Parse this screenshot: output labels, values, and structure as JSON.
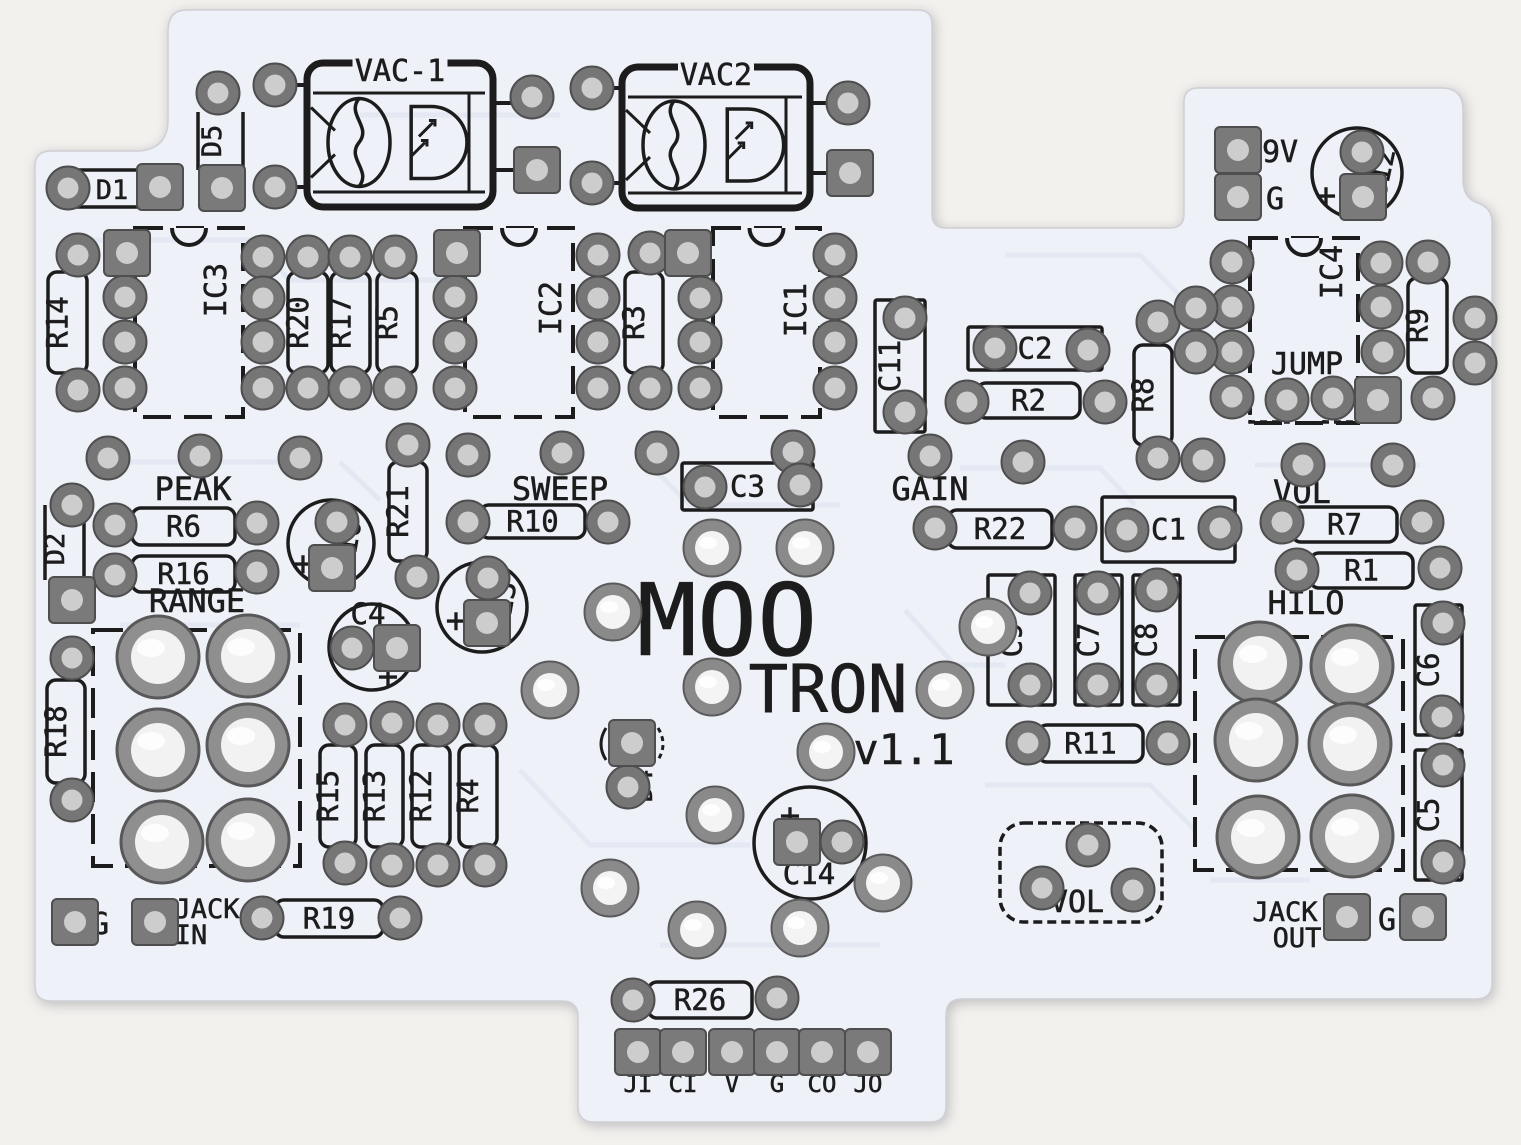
{
  "meta": {
    "subject": "MOO TRON v1.1 guitar-pedal PCB silkscreen scan"
  },
  "colors": {
    "page_bg": "#f3f1ee",
    "board": "#eef1f8",
    "silk": "#1c1c1c",
    "trace": "#e2e6f1",
    "pad_ring": "#767676",
    "pad_edge": "#4e4e4e",
    "hole_gray": "#cdcdcd",
    "hole_bright": "#f4f4f4",
    "big_ring": "#8f8f8f"
  },
  "symbols": {
    "plus": "+"
  },
  "labels": [
    {
      "t": "PEAK",
      "x": 193,
      "y": 500,
      "s": 32
    },
    {
      "t": "RANGE",
      "x": 197,
      "y": 612,
      "s": 32
    },
    {
      "t": "SWEEP",
      "x": 560,
      "y": 500,
      "s": 32
    },
    {
      "t": "GAIN",
      "x": 930,
      "y": 500,
      "s": 32
    },
    {
      "t": "VOL",
      "x": 1302,
      "y": 503,
      "s": 32
    },
    {
      "t": "HILO",
      "x": 1306,
      "y": 614,
      "s": 32
    },
    {
      "t": "JUMP",
      "x": 1307,
      "y": 374,
      "s": 30
    },
    {
      "t": "9V",
      "x": 1262,
      "y": 162,
      "s": 30,
      "anchor": "start"
    },
    {
      "t": "G",
      "x": 1266,
      "y": 209,
      "s": 30,
      "anchor": "start"
    },
    {
      "t": "G",
      "x": 100,
      "y": 934,
      "s": 30
    },
    {
      "t": "JACK",
      "x": 207,
      "y": 918,
      "s": 27
    },
    {
      "t": "IN",
      "x": 191,
      "y": 944,
      "s": 27
    },
    {
      "t": "JACK",
      "x": 1285,
      "y": 921,
      "s": 27
    },
    {
      "t": "OUT",
      "x": 1297,
      "y": 947,
      "s": 27
    },
    {
      "t": "G",
      "x": 1387,
      "y": 930,
      "s": 30
    },
    {
      "t": "MOO",
      "x": 727,
      "y": 655,
      "s": 100
    },
    {
      "t": "TRON",
      "x": 828,
      "y": 712,
      "s": 66
    },
    {
      "t": "v1.1",
      "x": 904,
      "y": 764,
      "s": 42
    },
    {
      "t": "VOL",
      "x": 1077,
      "y": 912,
      "s": 30
    },
    {
      "t": "JI",
      "x": 638,
      "y": 1092,
      "s": 24
    },
    {
      "t": "CI",
      "x": 683,
      "y": 1092,
      "s": 24
    },
    {
      "t": "V",
      "x": 732,
      "y": 1092,
      "s": 24
    },
    {
      "t": "G",
      "x": 777,
      "y": 1092,
      "s": 24
    },
    {
      "t": "CO",
      "x": 822,
      "y": 1092,
      "s": 24
    },
    {
      "t": "JO",
      "x": 868,
      "y": 1092,
      "s": 24
    }
  ],
  "resistors": [
    {
      "label": "R14",
      "x": 48,
      "y": 272,
      "w": 39,
      "h": 101,
      "vert": true
    },
    {
      "label": "R20",
      "x": 288,
      "y": 272,
      "w": 40,
      "h": 101,
      "vert": true
    },
    {
      "label": "R17",
      "x": 331,
      "y": 272,
      "w": 39,
      "h": 101,
      "vert": true
    },
    {
      "label": "R5",
      "x": 377,
      "y": 272,
      "w": 40,
      "h": 101,
      "vert": true
    },
    {
      "label": "R3",
      "x": 625,
      "y": 272,
      "w": 38,
      "h": 101,
      "vert": true
    },
    {
      "label": "R8",
      "x": 1134,
      "y": 345,
      "w": 38,
      "h": 100,
      "vert": true
    },
    {
      "label": "R9",
      "x": 1408,
      "y": 278,
      "w": 39,
      "h": 95,
      "vert": true
    },
    {
      "label": "R21",
      "x": 389,
      "y": 462,
      "w": 38,
      "h": 99,
      "vert": true
    },
    {
      "label": "R18",
      "x": 47,
      "y": 680,
      "w": 38,
      "h": 103,
      "vert": true
    },
    {
      "label": "R15",
      "x": 320,
      "y": 745,
      "w": 36,
      "h": 102,
      "vert": true
    },
    {
      "label": "R13",
      "x": 366,
      "y": 745,
      "w": 37,
      "h": 102,
      "vert": true
    },
    {
      "label": "R12",
      "x": 412,
      "y": 745,
      "w": 38,
      "h": 102,
      "vert": true
    },
    {
      "label": "R4",
      "x": 459,
      "y": 745,
      "w": 38,
      "h": 102,
      "vert": true
    },
    {
      "label": "R6",
      "x": 132,
      "y": 508,
      "w": 103,
      "h": 37,
      "vert": false
    },
    {
      "label": "R16",
      "x": 132,
      "y": 556,
      "w": 103,
      "h": 36,
      "vert": false
    },
    {
      "label": "R10",
      "x": 480,
      "y": 505,
      "w": 105,
      "h": 33,
      "vert": false
    },
    {
      "label": "R22",
      "x": 948,
      "y": 510,
      "w": 104,
      "h": 38,
      "vert": false
    },
    {
      "label": "R2",
      "x": 977,
      "y": 383,
      "w": 103,
      "h": 35,
      "vert": false
    },
    {
      "label": "R7",
      "x": 1292,
      "y": 507,
      "w": 105,
      "h": 35,
      "vert": false
    },
    {
      "label": "R1",
      "x": 1310,
      "y": 553,
      "w": 103,
      "h": 35,
      "vert": false
    },
    {
      "label": "R11",
      "x": 1038,
      "y": 725,
      "w": 105,
      "h": 37,
      "vert": false
    },
    {
      "label": "R19",
      "x": 275,
      "y": 900,
      "w": 108,
      "h": 37,
      "vert": false
    },
    {
      "label": "R26",
      "x": 648,
      "y": 982,
      "w": 104,
      "h": 36,
      "vert": false
    }
  ],
  "cap_boxes": [
    {
      "label": "C11",
      "x": 875,
      "y": 300,
      "w": 50,
      "h": 132,
      "vert": true
    },
    {
      "label": "C2",
      "x": 968,
      "y": 327,
      "w": 134,
      "h": 43,
      "vert": false
    },
    {
      "label": "C1",
      "x": 1102,
      "y": 497,
      "w": 133,
      "h": 65,
      "vert": false
    },
    {
      "label": "C3",
      "x": 682,
      "y": 463,
      "w": 131,
      "h": 47,
      "vert": false
    },
    {
      "label": "C9",
      "x": 988,
      "y": 575,
      "w": 67,
      "h": 130,
      "vert": true
    },
    {
      "label": "C7",
      "x": 1075,
      "y": 575,
      "w": 47,
      "h": 130,
      "vert": true
    },
    {
      "label": "C8",
      "x": 1133,
      "y": 575,
      "w": 47,
      "h": 130,
      "vert": true
    },
    {
      "label": "C6",
      "x": 1415,
      "y": 605,
      "w": 47,
      "h": 130,
      "vert": true
    },
    {
      "label": "C5",
      "x": 1415,
      "y": 750,
      "w": 47,
      "h": 130,
      "vert": true
    }
  ],
  "ics": [
    {
      "label": "IC3",
      "x": 135,
      "y": 228,
      "w": 108,
      "h": 189,
      "lx": 226,
      "ly": 290
    },
    {
      "label": "IC2",
      "x": 465,
      "y": 228,
      "w": 108,
      "h": 189,
      "lx": 561,
      "ly": 308
    },
    {
      "label": "IC1",
      "x": 713,
      "y": 228,
      "w": 107,
      "h": 189,
      "lx": 806,
      "ly": 310
    },
    {
      "label": "IC4",
      "x": 1250,
      "y": 238,
      "w": 108,
      "h": 185,
      "lx": 1342,
      "ly": 272
    }
  ],
  "optos": [
    {
      "label": "VAC-1",
      "x": 307,
      "y": 63,
      "w": 186,
      "h": 144
    },
    {
      "label": "VAC2",
      "x": 622,
      "y": 67,
      "w": 188,
      "h": 141
    }
  ],
  "ecaps": [
    {
      "label": "C12",
      "cx": 1357,
      "cy": 173,
      "r": 45,
      "px": 1326,
      "py": 198,
      "lx": 1390,
      "ly": 176,
      "lrot": -78
    },
    {
      "label": "C10",
      "cx": 331,
      "cy": 543,
      "r": 43,
      "px": 303,
      "py": 566,
      "lx": 357,
      "ly": 547,
      "lrot": -80
    },
    {
      "label": "C13",
      "cx": 482,
      "cy": 607,
      "r": 45,
      "px": 456,
      "py": 623,
      "lx": 512,
      "ly": 609,
      "lrot": -80
    },
    {
      "label": "C4",
      "cx": 372,
      "cy": 647,
      "r": 43,
      "px": 388,
      "py": 679,
      "lx": 368,
      "ly": 624,
      "lrot": 0
    },
    {
      "label": "C14",
      "cx": 810,
      "cy": 843,
      "r": 56,
      "px": 790,
      "py": 818,
      "lx": 809,
      "ly": 884,
      "lrot": 0
    }
  ],
  "diodes": [
    {
      "label": "D1",
      "lx": 112,
      "ly": 199,
      "rot": 0,
      "lines": [
        [
          70,
          170,
          143,
          170
        ],
        [
          70,
          207,
          143,
          207
        ]
      ]
    },
    {
      "label": "D5",
      "lx": 221,
      "ly": 141,
      "rot": -90,
      "lines": [
        [
          198,
          112,
          198,
          170
        ],
        [
          243,
          112,
          243,
          170
        ]
      ]
    },
    {
      "label": "D2",
      "lx": 64,
      "ly": 549,
      "rot": -90,
      "lines": [
        [
          45,
          505,
          45,
          580
        ],
        [
          84,
          505,
          84,
          580
        ]
      ]
    },
    {
      "label": "D4",
      "lx": 652,
      "ly": 786,
      "rot": -90,
      "lines": [],
      "parens": [
        [
          606,
          728
        ],
        [
          658,
          728
        ]
      ]
    }
  ],
  "brackets": [
    {
      "x": 93,
      "y": 630,
      "w": 207,
      "h": 236
    },
    {
      "x": 1195,
      "y": 637,
      "w": 208,
      "h": 233
    }
  ],
  "vol_box": {
    "x": 1000,
    "y": 823,
    "w": 162,
    "h": 99
  },
  "jumper_brackets": [
    [
      1250,
      408
    ],
    [
      1324,
      408
    ]
  ],
  "stubs": [
    [
      296,
      85,
      308,
      85
    ],
    [
      296,
      187,
      308,
      187
    ],
    [
      493,
      103,
      514,
      103
    ],
    [
      493,
      170,
      516,
      170
    ],
    [
      613,
      88,
      623,
      88
    ],
    [
      613,
      183,
      623,
      183
    ],
    [
      810,
      103,
      829,
      103
    ],
    [
      810,
      173,
      830,
      173
    ]
  ],
  "pads": {
    "round": [
      [
        68,
        188
      ],
      [
        218,
        93
      ],
      [
        275,
        85
      ],
      [
        275,
        187
      ],
      [
        532,
        97
      ],
      [
        592,
        88
      ],
      [
        592,
        183
      ],
      [
        848,
        103
      ],
      [
        78,
        255
      ],
      [
        78,
        390
      ],
      [
        125,
        297
      ],
      [
        125,
        342
      ],
      [
        125,
        388
      ],
      [
        263,
        257
      ],
      [
        263,
        298
      ],
      [
        263,
        342
      ],
      [
        263,
        388
      ],
      [
        308,
        257
      ],
      [
        308,
        388
      ],
      [
        350,
        257
      ],
      [
        350,
        388
      ],
      [
        395,
        257
      ],
      [
        395,
        388
      ],
      [
        455,
        297
      ],
      [
        455,
        342
      ],
      [
        455,
        388
      ],
      [
        598,
        255
      ],
      [
        598,
        298
      ],
      [
        598,
        342
      ],
      [
        598,
        388
      ],
      [
        650,
        253
      ],
      [
        650,
        388
      ],
      [
        700,
        298
      ],
      [
        700,
        342
      ],
      [
        700,
        388
      ],
      [
        835,
        255
      ],
      [
        835,
        298
      ],
      [
        835,
        342
      ],
      [
        835,
        388
      ],
      [
        905,
        318
      ],
      [
        905,
        412
      ],
      [
        995,
        348
      ],
      [
        1088,
        350
      ],
      [
        967,
        402
      ],
      [
        1105,
        402
      ],
      [
        1158,
        322
      ],
      [
        1158,
        458
      ],
      [
        1232,
        262
      ],
      [
        1232,
        307
      ],
      [
        1232,
        352
      ],
      [
        1232,
        397
      ],
      [
        1381,
        263
      ],
      [
        1381,
        307
      ],
      [
        1383,
        352
      ],
      [
        1428,
        262
      ],
      [
        1433,
        398
      ],
      [
        1287,
        400
      ],
      [
        1333,
        398
      ],
      [
        1196,
        308
      ],
      [
        1196,
        352
      ],
      [
        1475,
        318
      ],
      [
        1475,
        363
      ],
      [
        1362,
        152
      ],
      [
        108,
        458
      ],
      [
        200,
        456
      ],
      [
        300,
        458
      ],
      [
        468,
        455
      ],
      [
        562,
        453
      ],
      [
        657,
        453
      ],
      [
        793,
        452
      ],
      [
        930,
        456
      ],
      [
        1023,
        462
      ],
      [
        1203,
        460
      ],
      [
        1303,
        465
      ],
      [
        1393,
        465
      ],
      [
        72,
        505
      ],
      [
        115,
        525
      ],
      [
        257,
        523
      ],
      [
        115,
        575
      ],
      [
        257,
        572
      ],
      [
        337,
        522
      ],
      [
        408,
        445
      ],
      [
        417,
        577
      ],
      [
        468,
        522
      ],
      [
        608,
        522
      ],
      [
        488,
        578
      ],
      [
        352,
        648
      ],
      [
        705,
        487
      ],
      [
        800,
        485
      ],
      [
        935,
        528
      ],
      [
        1075,
        528
      ],
      [
        1127,
        530
      ],
      [
        1220,
        528
      ],
      [
        1282,
        522
      ],
      [
        1422,
        522
      ],
      [
        1297,
        570
      ],
      [
        1440,
        568
      ],
      [
        1030,
        593
      ],
      [
        1030,
        685
      ],
      [
        1098,
        593
      ],
      [
        1098,
        685
      ],
      [
        1157,
        590
      ],
      [
        1157,
        685
      ],
      [
        1028,
        743
      ],
      [
        1168,
        743
      ],
      [
        1443,
        623
      ],
      [
        1442,
        717
      ],
      [
        1443,
        765
      ],
      [
        1443,
        862
      ],
      [
        72,
        658
      ],
      [
        72,
        800
      ],
      [
        345,
        725
      ],
      [
        392,
        723
      ],
      [
        438,
        725
      ],
      [
        485,
        725
      ],
      [
        345,
        863
      ],
      [
        392,
        865
      ],
      [
        438,
        865
      ],
      [
        485,
        865
      ],
      [
        628,
        787
      ],
      [
        842,
        842
      ],
      [
        262,
        918
      ],
      [
        400,
        918
      ],
      [
        1088,
        845
      ],
      [
        1042,
        888
      ],
      [
        1133,
        890
      ],
      [
        633,
        1000
      ],
      [
        777,
        998
      ]
    ],
    "square": [
      [
        160,
        187
      ],
      [
        222,
        188
      ],
      [
        537,
        170
      ],
      [
        850,
        173
      ],
      [
        127,
        253
      ],
      [
        457,
        253
      ],
      [
        688,
        253
      ],
      [
        1238,
        150
      ],
      [
        1238,
        197
      ],
      [
        1363,
        197
      ],
      [
        1378,
        400
      ],
      [
        72,
        600
      ],
      [
        332,
        568
      ],
      [
        487,
        623
      ],
      [
        397,
        648
      ],
      [
        632,
        743
      ],
      [
        797,
        842
      ],
      [
        75,
        922
      ],
      [
        155,
        922
      ],
      [
        1347,
        917
      ],
      [
        1423,
        917
      ],
      [
        638,
        1052
      ],
      [
        683,
        1052
      ],
      [
        732,
        1052
      ],
      [
        777,
        1052
      ],
      [
        822,
        1052
      ],
      [
        868,
        1052
      ]
    ],
    "bright": [
      [
        613,
        612
      ],
      [
        988,
        627
      ],
      [
        712,
        687
      ],
      [
        945,
        690
      ],
      [
        826,
        752
      ],
      [
        715,
        815
      ],
      [
        610,
        888
      ],
      [
        883,
        883
      ],
      [
        697,
        930
      ],
      [
        800,
        928
      ],
      [
        550,
        690
      ],
      [
        712,
        548
      ],
      [
        805,
        548
      ]
    ],
    "big": [
      [
        158,
        657
      ],
      [
        248,
        656
      ],
      [
        158,
        750
      ],
      [
        248,
        745
      ],
      [
        162,
        842
      ],
      [
        248,
        840
      ],
      [
        1260,
        663
      ],
      [
        1352,
        666
      ],
      [
        1256,
        740
      ],
      [
        1350,
        744
      ],
      [
        1258,
        837
      ],
      [
        1352,
        836
      ]
    ]
  }
}
